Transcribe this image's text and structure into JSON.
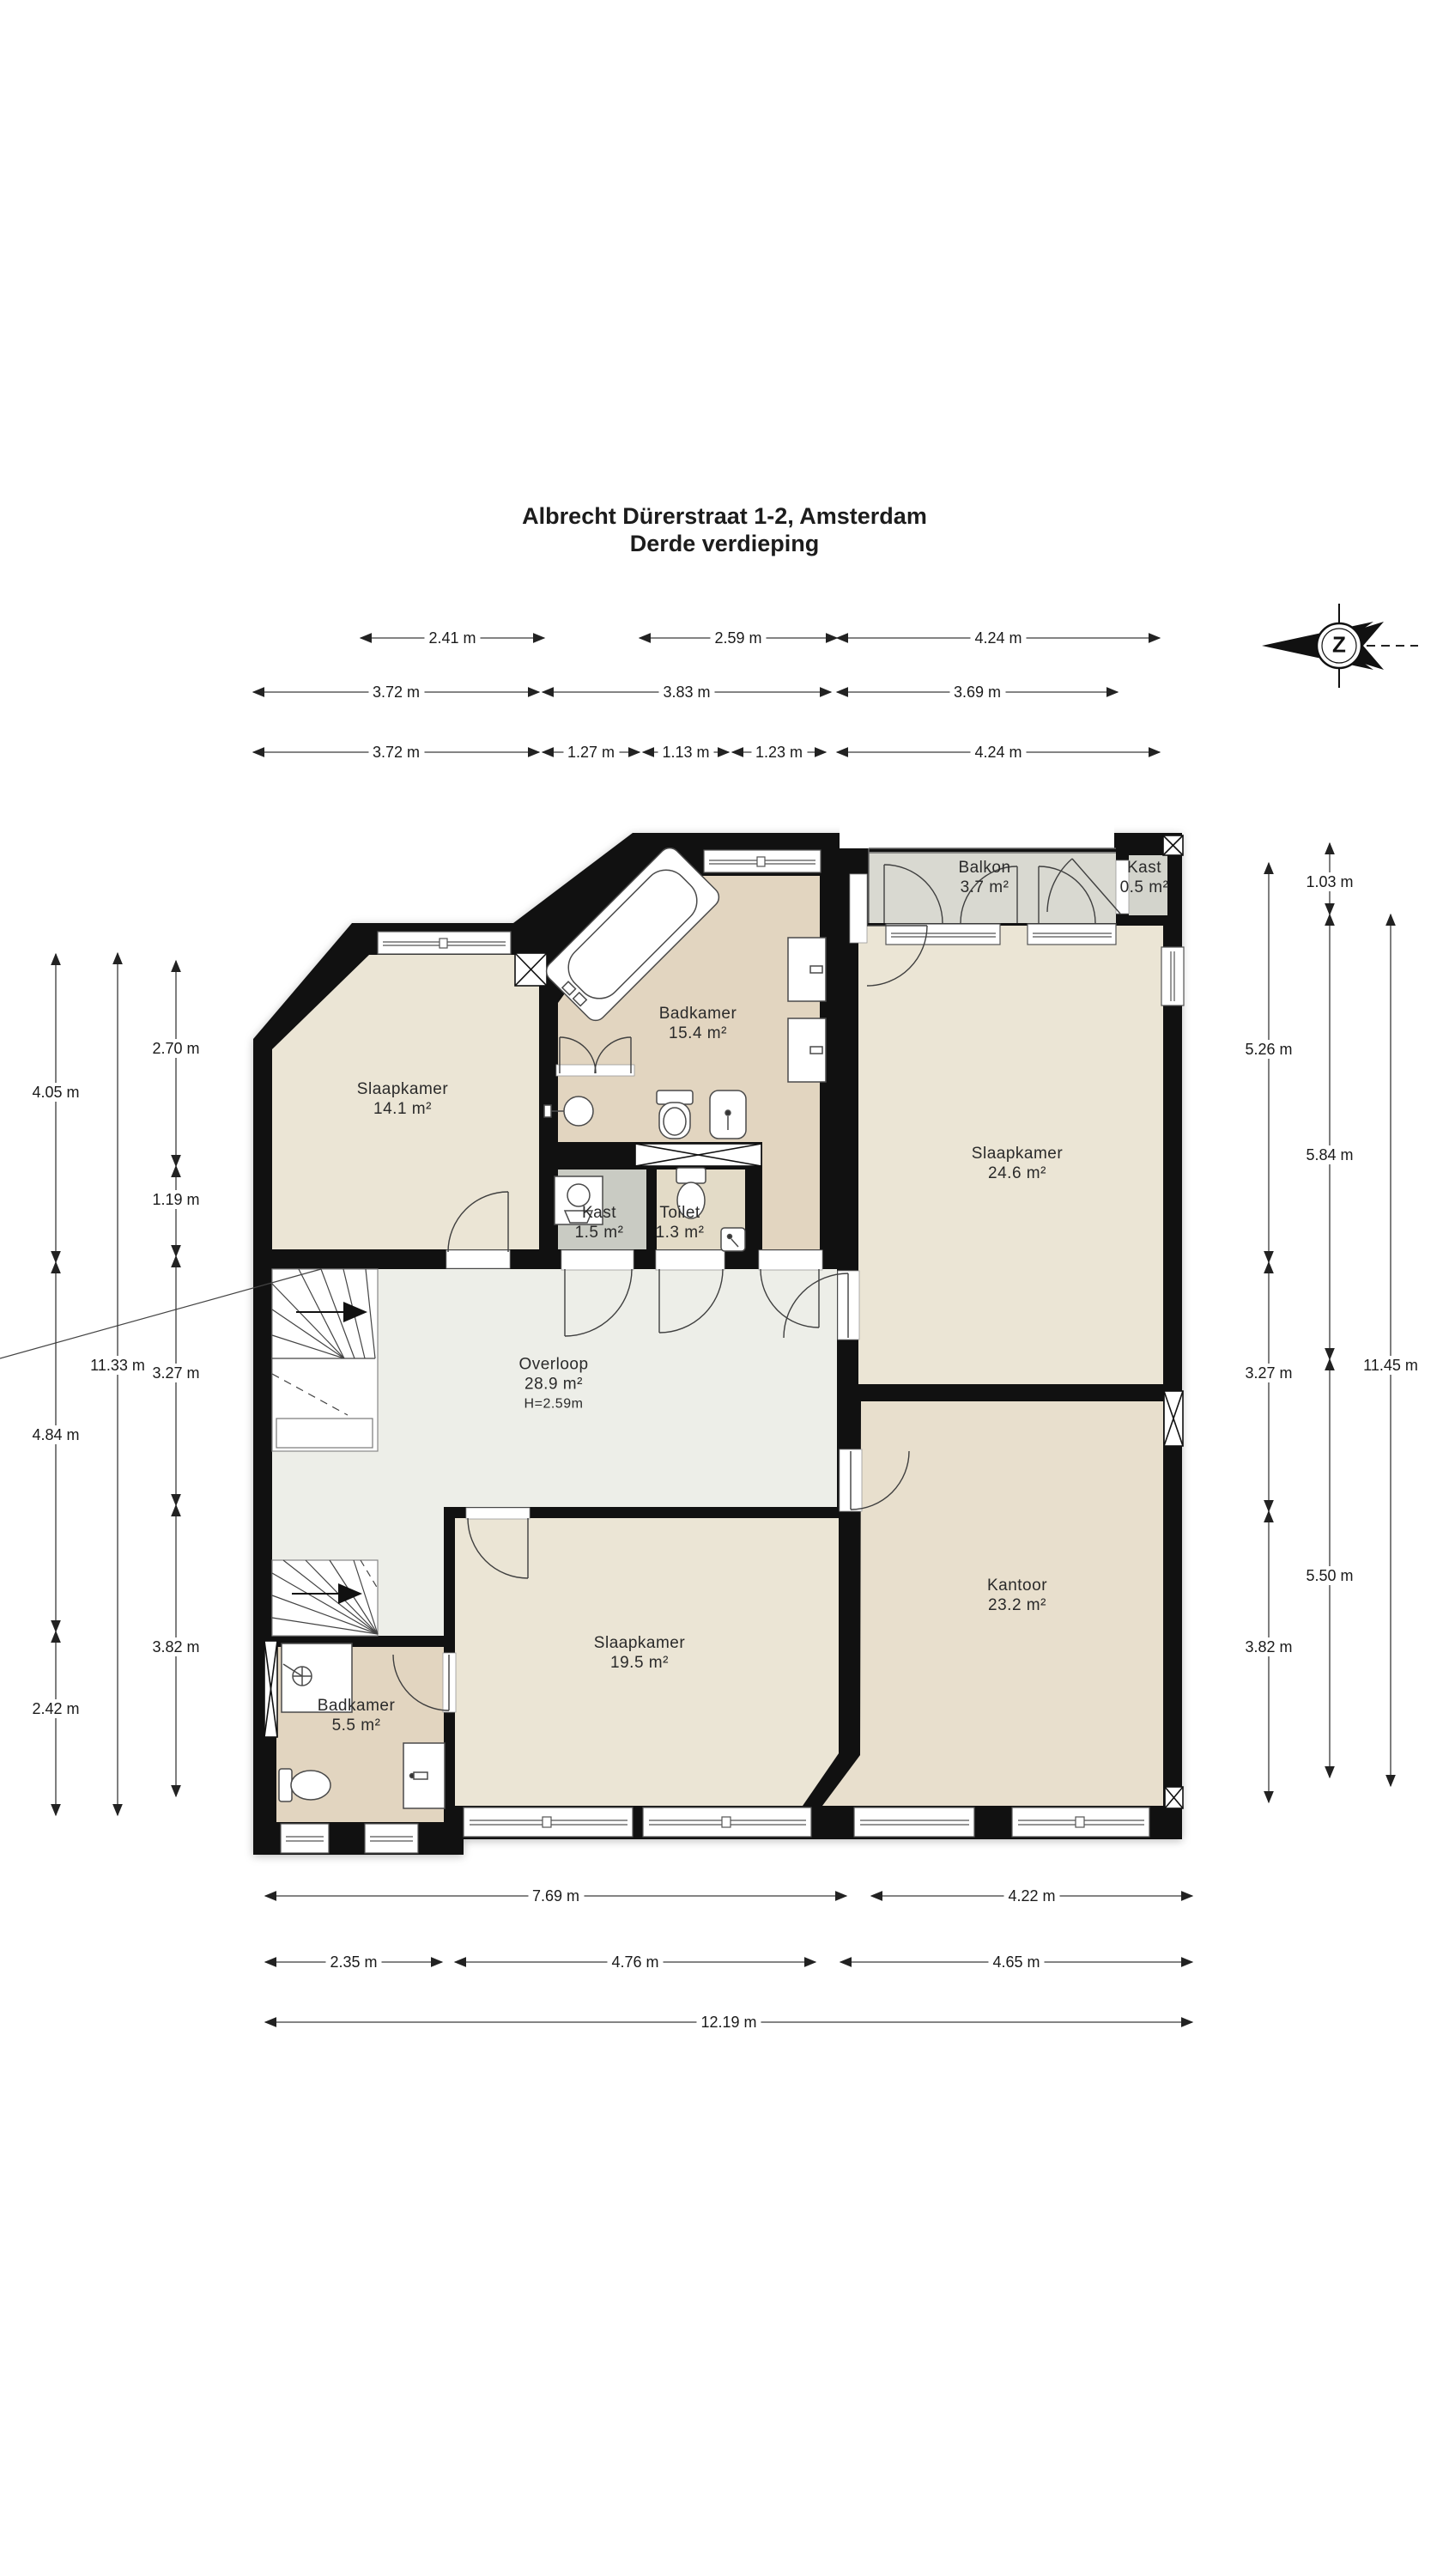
{
  "title": {
    "line1": "Albrecht Dürerstraat 1-2, Amsterdam",
    "line2": "Derde verdieping"
  },
  "compass": {
    "letter": "Z"
  },
  "rooms": [
    {
      "name": "Slaapkamer",
      "area": "14.1 m²"
    },
    {
      "name": "Badkamer",
      "area": "15.4 m²"
    },
    {
      "name": "Balkon",
      "area": "3.7 m²"
    },
    {
      "name": "Kast",
      "area": "0.5 m²"
    },
    {
      "name": "Slaapkamer",
      "area": "24.6 m²"
    },
    {
      "name": "Kast",
      "area": "1.5 m²"
    },
    {
      "name": "Toilet",
      "area": "1.3 m²"
    },
    {
      "name": "Overloop",
      "area": "28.9 m²",
      "height": "H=2.59m"
    },
    {
      "name": "Slaapkamer",
      "area": "19.5 m²"
    },
    {
      "name": "Kantoor",
      "area": "23.2 m²"
    },
    {
      "name": "Badkamer",
      "area": "5.5 m²"
    }
  ],
  "dimensions": {
    "top_row1": [
      "2.41 m",
      "2.59 m",
      "4.24 m"
    ],
    "top_row2": [
      "3.72 m",
      "3.83 m",
      "3.69 m"
    ],
    "top_row3": [
      "3.72 m",
      "1.27 m",
      "1.13 m",
      "1.23 m",
      "4.24 m"
    ],
    "left_outer": [
      "4.05 m",
      "4.84 m",
      "2.42 m"
    ],
    "left_middle": [
      "11.33 m"
    ],
    "left_inner": [
      "2.70 m",
      "1.19 m",
      "3.27 m",
      "3.82 m"
    ],
    "right_inner": [
      "5.26 m",
      "3.27 m",
      "3.82 m"
    ],
    "right_middle": [
      "1.03 m",
      "5.84 m",
      "5.50 m"
    ],
    "right_outer": [
      "11.45 m"
    ],
    "bottom_row1": [
      "7.69 m",
      "4.22 m"
    ],
    "bottom_row2": [
      "2.35 m",
      "4.76 m",
      "4.65 m"
    ],
    "bottom_row3": [
      "12.19 m"
    ]
  },
  "colors": {
    "wall": "#111111",
    "slaapkamer": "#ebe5d5",
    "badkamer": "#e2d5c0",
    "kantoor": "#e8dfcd",
    "overloop": "#edeee8",
    "balkon": "#d9d9d1",
    "kast-small": "#d3d4cc",
    "kast": "#c9cbc3",
    "toilet": "#e3dbc7",
    "fixture": "#4a4a4a",
    "dim": "#3a3a3a",
    "text": "#1c1c1c"
  }
}
